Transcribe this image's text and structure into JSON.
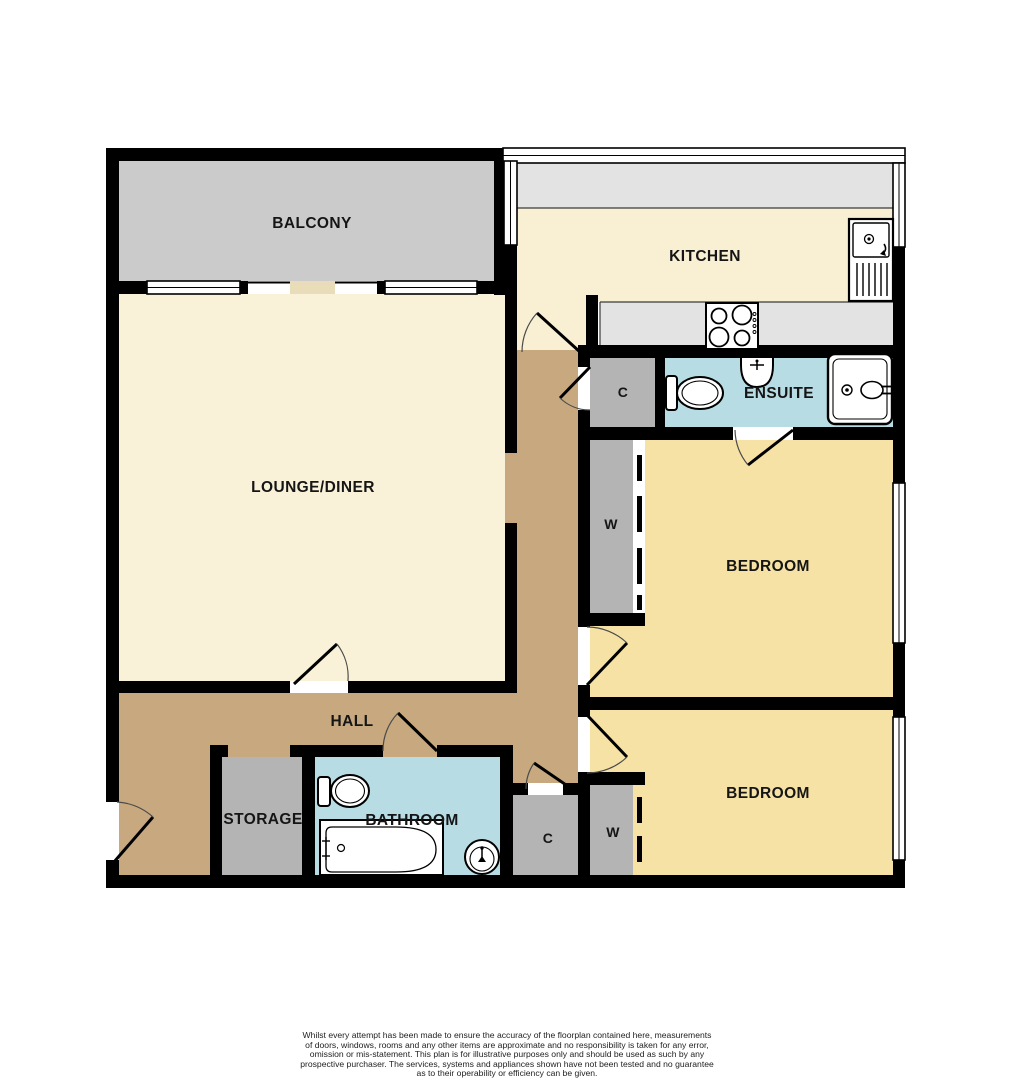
{
  "floorplan": {
    "rooms": {
      "balcony": {
        "label": "BALCONY"
      },
      "kitchen": {
        "label": "KITCHEN"
      },
      "lounge_diner": {
        "label": "LOUNGE/DINER"
      },
      "ensuite": {
        "label": "ENSUITE"
      },
      "bedroom_1": {
        "label": "BEDROOM"
      },
      "bedroom_2": {
        "label": "BEDROOM"
      },
      "hall": {
        "label": "HALL"
      },
      "storage": {
        "label": "STORAGE"
      },
      "bathroom": {
        "label": "BATHROOM"
      },
      "closet_upper": {
        "label": "C"
      },
      "closet_lower": {
        "label": "C"
      },
      "wardrobe_upper": {
        "label": "W"
      },
      "wardrobe_lower": {
        "label": "W"
      }
    },
    "colors": {
      "wall": "#000000",
      "balcony_floor": "#cbcbcb",
      "kitchen_counter": "#e3e3e3",
      "cream_floor": "#faf2d8",
      "bedroom_floor": "#f6e2a5",
      "hall_floor": "#c8a97f",
      "wet_room_floor": "#b7dce3",
      "closet_floor": "#b4b4b4",
      "window": "#ffffff"
    },
    "disclaimer": {
      "line1": "Whilst every attempt has been made to ensure the accuracy of the floorplan contained here, measurements",
      "line2": "of doors, windows, rooms and any other items are approximate and no responsibility is taken for any error,",
      "line3": "omission or mis-statement. This plan is for illustrative purposes only and should be used as such by any",
      "line4": "prospective purchaser. The services, systems and appliances shown have not been tested and no guarantee",
      "line5": "as to their operability or efficiency can be given.",
      "line6": "Made with Metropix ©2026"
    }
  }
}
